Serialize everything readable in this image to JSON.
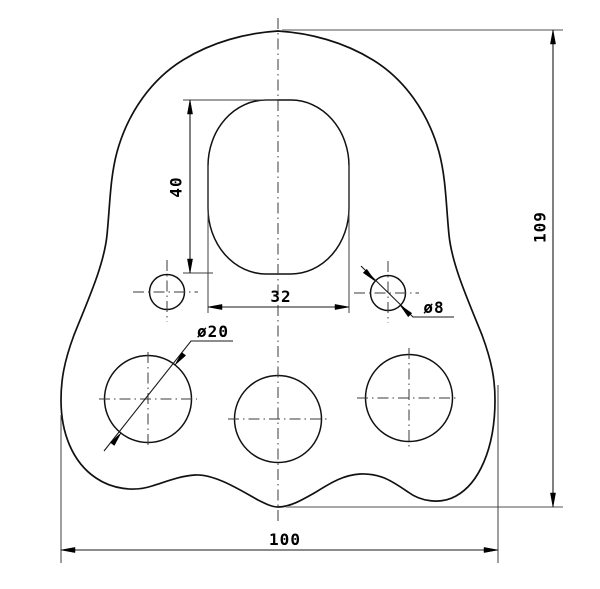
{
  "drawing": {
    "kind": "technical-drawing",
    "part": "rigging-plate-with-holes",
    "units": "mm",
    "background_color": "#ffffff",
    "line_color": "#111111",
    "extension_line_color": "#8a8a8a",
    "dimensions": {
      "overall_width": {
        "label": "100",
        "value": 100
      },
      "overall_height": {
        "label": "109",
        "value": 109
      },
      "slot_width": {
        "label": "32",
        "value": 32
      },
      "slot_height": {
        "label": "40",
        "value": 40
      },
      "small_hole_diameter": {
        "label": "ø8",
        "value": 8
      },
      "large_hole_diameter": {
        "label": "ø20",
        "value": 20
      }
    },
    "features": {
      "slot_count": 1,
      "small_hole_count": 2,
      "large_hole_count": 3
    }
  }
}
